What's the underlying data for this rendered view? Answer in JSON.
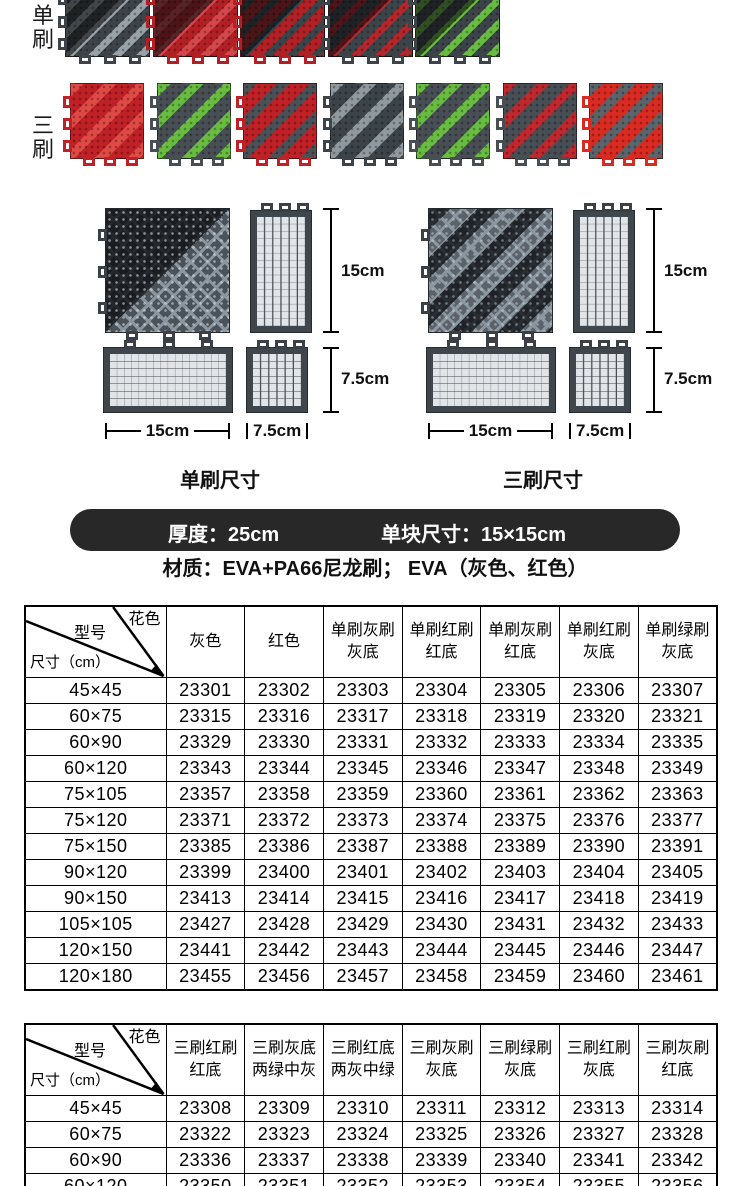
{
  "products": {
    "row1_label": "单刷",
    "row2_label": "三刷",
    "row1_tiles": [
      {
        "name": "单刷灰刷灰底",
        "base": "#3d4449",
        "stripe": "#98a2a8"
      },
      {
        "name": "单刷红刷红底",
        "base": "#b22025",
        "stripe": "#d4484c"
      },
      {
        "name": "单刷灰刷红底",
        "base": "#b22025",
        "stripe": "#3d4449"
      },
      {
        "name": "单刷红刷灰底",
        "base": "#3d4449",
        "stripe": "#b2262c"
      },
      {
        "name": "单刷绿刷灰底",
        "base": "#3d4449",
        "stripe": "#68bd41"
      }
    ],
    "row2_tiles": [
      {
        "name": "三刷红刷红底",
        "base": "#c02127",
        "stripe": "#e04a45"
      },
      {
        "name": "三刷灰底两绿中灰",
        "base": "#474e54",
        "stripe": "#68bd41"
      },
      {
        "name": "三刷红底两灰中绿",
        "base": "#c02127",
        "stripe": "#4a5157"
      },
      {
        "name": "三刷灰刷灰底",
        "base": "#3d4449",
        "stripe": "#8f999f"
      },
      {
        "name": "三刷绿刷灰底",
        "base": "#474e54",
        "stripe": "#68bd41"
      },
      {
        "name": "三刷红刷灰底",
        "base": "#474e54",
        "stripe": "#c0282e"
      },
      {
        "name": "三刷灰刷红底",
        "base": "#d92b22",
        "stripe": "#5a646b"
      }
    ]
  },
  "diagrams": {
    "left": {
      "caption": "单刷尺寸",
      "height_label": "15cm",
      "small_height_label": "7.5cm",
      "width_label": "15cm",
      "small_width_label": "7.5cm"
    },
    "right": {
      "caption": "三刷尺寸",
      "height_label": "15cm",
      "small_height_label": "7.5cm",
      "width_label": "15cm",
      "small_width_label": "7.5cm"
    }
  },
  "banner": {
    "thickness": "厚度：25cm",
    "unit_size": "单块尺寸：15×15cm",
    "bg": "#282828"
  },
  "material_line": "材质：EVA+PA66尼龙刷； EVA（灰色、红色）",
  "table1": {
    "corner": {
      "top": "花色",
      "mid": "型号",
      "bottom": "尺寸（cm）"
    },
    "headers": [
      [
        "灰色"
      ],
      [
        "红色"
      ],
      [
        "单刷灰刷",
        "灰底"
      ],
      [
        "单刷红刷",
        "红底"
      ],
      [
        "单刷灰刷",
        "红底"
      ],
      [
        "单刷红刷",
        "灰底"
      ],
      [
        "单刷绿刷",
        "灰底"
      ]
    ],
    "rows": [
      [
        "45×45",
        "23301",
        "23302",
        "23303",
        "23304",
        "23305",
        "23306",
        "23307"
      ],
      [
        "60×75",
        "23315",
        "23316",
        "23317",
        "23318",
        "23319",
        "23320",
        "23321"
      ],
      [
        "60×90",
        "23329",
        "23330",
        "23331",
        "23332",
        "23333",
        "23334",
        "23335"
      ],
      [
        "60×120",
        "23343",
        "23344",
        "23345",
        "23346",
        "23347",
        "23348",
        "23349"
      ],
      [
        "75×105",
        "23357",
        "23358",
        "23359",
        "23360",
        "23361",
        "23362",
        "23363"
      ],
      [
        "75×120",
        "23371",
        "23372",
        "23373",
        "23374",
        "23375",
        "23376",
        "23377"
      ],
      [
        "75×150",
        "23385",
        "23386",
        "23387",
        "23388",
        "23389",
        "23390",
        "23391"
      ],
      [
        "90×120",
        "23399",
        "23400",
        "23401",
        "23402",
        "23403",
        "23404",
        "23405"
      ],
      [
        "90×150",
        "23413",
        "23414",
        "23415",
        "23416",
        "23417",
        "23418",
        "23419"
      ],
      [
        "105×105",
        "23427",
        "23428",
        "23429",
        "23430",
        "23431",
        "23432",
        "23433"
      ],
      [
        "120×150",
        "23441",
        "23442",
        "23443",
        "23444",
        "23445",
        "23446",
        "23447"
      ],
      [
        "120×180",
        "23455",
        "23456",
        "23457",
        "23458",
        "23459",
        "23460",
        "23461"
      ]
    ]
  },
  "table2": {
    "corner": {
      "top": "花色",
      "mid": "型号",
      "bottom": "尺寸（cm）"
    },
    "headers": [
      [
        "三刷红刷",
        "红底"
      ],
      [
        "三刷灰底",
        "两绿中灰"
      ],
      [
        "三刷红底",
        "两灰中绿"
      ],
      [
        "三刷灰刷",
        "灰底"
      ],
      [
        "三刷绿刷",
        "灰底"
      ],
      [
        "三刷红刷",
        "灰底"
      ],
      [
        "三刷灰刷",
        "红底"
      ]
    ],
    "rows": [
      [
        "45×45",
        "23308",
        "23309",
        "23310",
        "23311",
        "23312",
        "23313",
        "23314"
      ],
      [
        "60×75",
        "23322",
        "23323",
        "23324",
        "23325",
        "23326",
        "23327",
        "23328"
      ],
      [
        "60×90",
        "23336",
        "23337",
        "23338",
        "23339",
        "23340",
        "23341",
        "23342"
      ],
      [
        "60×120",
        "23350",
        "23351",
        "23352",
        "23353",
        "23354",
        "23355",
        "23356"
      ]
    ]
  }
}
